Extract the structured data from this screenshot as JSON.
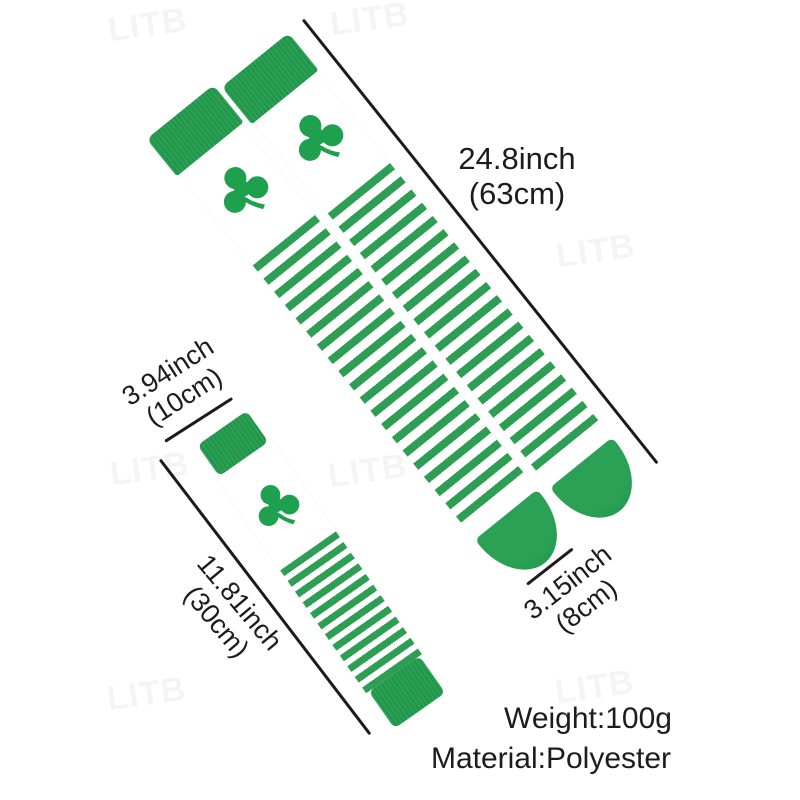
{
  "watermark": {
    "text": "LITB"
  },
  "colors": {
    "green": "#2E9E54",
    "clover": "#1FA04E",
    "ink": "#1c1c1c"
  },
  "annotations": {
    "sock_length": {
      "line1": "24.8inch",
      "line2": "(63cm)"
    },
    "warmer_width": {
      "line1": "3.94inch",
      "line2": "(10cm)"
    },
    "warmer_length": {
      "line1": "11.81inch",
      "line2": "(30cm)"
    },
    "sock_foot": {
      "line1": "3.15inch",
      "line2": "(8cm)"
    }
  },
  "specs": {
    "weight": "Weight:100g",
    "material": "Material:Polyester"
  }
}
